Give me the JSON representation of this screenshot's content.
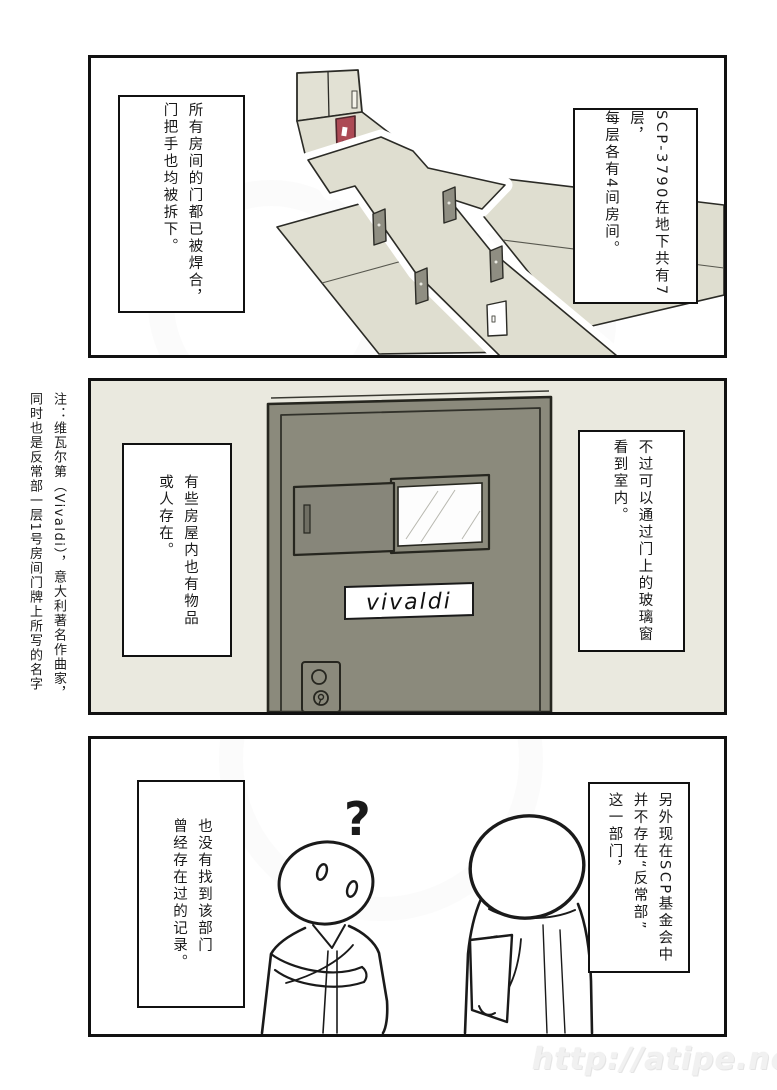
{
  "page": {
    "type": "comic-page",
    "watermark_url": "http://atipe.net/"
  },
  "margin_note": {
    "text": "注：维瓦尔第（Vivaldi），意大利著名作曲家，\n同时也是反常部一层1号房间门牌上所写的名字"
  },
  "panel1": {
    "description": "isometric-floor-plan-with-elevator-red-door-and-detached-doors",
    "right_balloon": "SCP-3790在地下共有7层，\n每层各有4间房间。",
    "left_balloon": "所有房间的门都已被焊合，\n门把手也均被拆下。"
  },
  "panel2": {
    "description": "cell-door-with-sliding-window-and-nameplate",
    "right_balloon": "不过可以通过门上的玻璃窗\n看到室内。",
    "left_balloon": "有些房屋内也有物品\n或人存在。",
    "door_nameplate": "vivaldi"
  },
  "panel3": {
    "description": "two-researchers-talking-one-confused-one-holding-clipboard",
    "right_balloon": "另外现在SCP基金会中\n并不存在“反常部”\n这一部门，",
    "left_balloon": "也没有找到该部门\n曾经存在过的记录。",
    "question_mark": "?"
  },
  "colors": {
    "ink": "#1a1a1a",
    "floor_beige": "#dfded0",
    "panel2_background": "#eae9df",
    "door_gray": "#8b8a7c",
    "red_door": "#ac4a55",
    "glass_white": "#fdfdfd"
  }
}
